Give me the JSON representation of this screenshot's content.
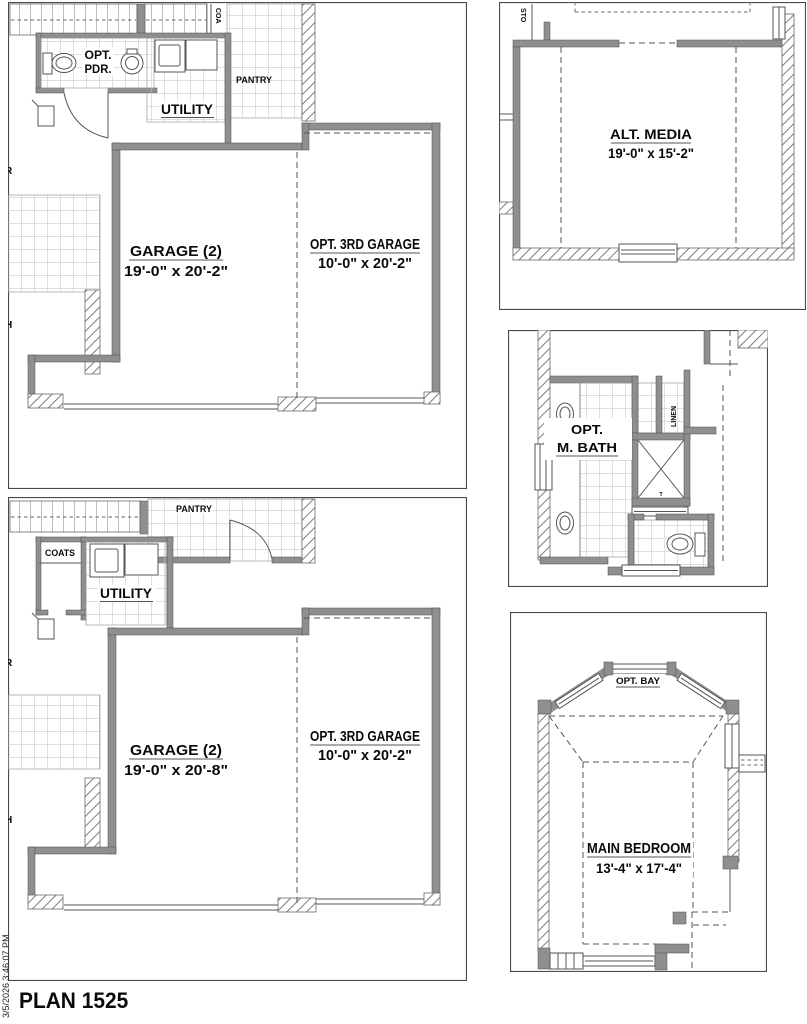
{
  "page": {
    "title": "PLAN 1525",
    "timestamp_vertical": "3/5/2026 3:46:07 PM"
  },
  "first_floor_plan": {
    "powder_line1": "OPT.",
    "powder_line2": "PDR.",
    "utility_label": "UTILITY",
    "pantry_label": "PANTRY",
    "coats_vertical_label": "COA",
    "garage": {
      "name": "GARAGE (2)",
      "dims": "19'-0\" x 20'-2\""
    },
    "opt_third_garage": {
      "name": "OPT. 3RD GARAGE",
      "dims": "10'-0\" x 20'-2\""
    },
    "left_edge_label_top": "R",
    "left_edge_label_bottom": "H"
  },
  "alt_garage_plan": {
    "coats_label": "COATS",
    "utility_label": "UTILITY",
    "pantry_label": "PANTRY",
    "garage": {
      "name": "GARAGE (2)",
      "dims": "19'-0\" x 20'-8\""
    },
    "opt_third_garage": {
      "name": "OPT. 3RD GARAGE",
      "dims": "10'-0\" x 20'-2\""
    },
    "left_edge_label_top": "R",
    "left_edge_label_bottom": "H"
  },
  "alt_media_plan": {
    "room": {
      "name": "ALT. MEDIA",
      "dims": "19'-0\" x 15'-2\""
    },
    "storage_vertical_label": "STO"
  },
  "opt_master_bath_plan": {
    "room_line1": "OPT.",
    "room_line2": "M. BATH",
    "linen_vertical_label": "LINEN",
    "shower_marker": "T"
  },
  "main_bedroom_plan": {
    "opt_bay_label": "OPT. BAY",
    "room": {
      "name": "MAIN BEDROOM",
      "dims": "13'-4\" x 17'-4\""
    }
  }
}
